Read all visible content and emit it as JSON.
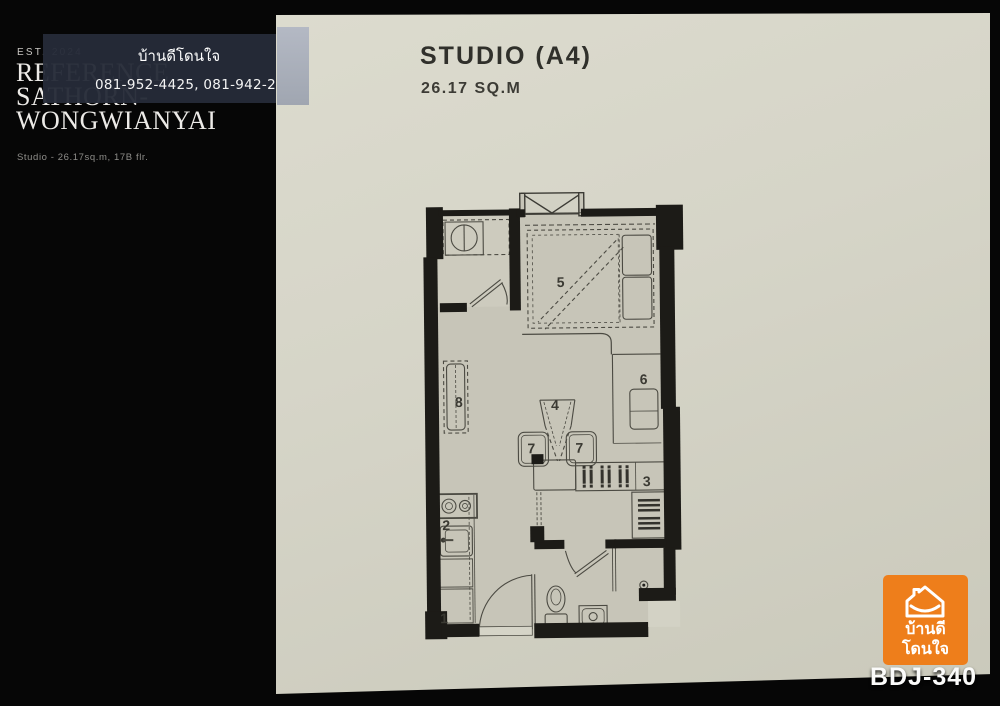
{
  "left_panel": {
    "established": "EST. 2024",
    "brand_line1": "REFERENCE",
    "brand_line2": "SATHORN-",
    "brand_line3": "WONGWIANYAI",
    "subtitle": "Studio - 26.17sq.m, 17B flr."
  },
  "watermark": {
    "agency_name": "บ้านดีโดนใจ",
    "phone_numbers": "081-952-4425, 081-942-2426"
  },
  "plan_header": {
    "title": "STUDIO (A4)",
    "area": "26.17 SQ.M"
  },
  "floor_plan": {
    "room_labels": [
      "1",
      "2",
      "3",
      "4",
      "5",
      "6",
      "7",
      "7",
      "8"
    ]
  },
  "logo": {
    "name_line1": "บ้านดี",
    "name_line2": "โดนใจ",
    "listing_code": "BDJ-340",
    "brand_color": "#ee7e1b"
  },
  "colors": {
    "background": "#060606",
    "paper": "#d6d5c8",
    "overlay": "#252b38",
    "wall": "#1c1b17",
    "logo_orange": "#ee7e1b"
  }
}
